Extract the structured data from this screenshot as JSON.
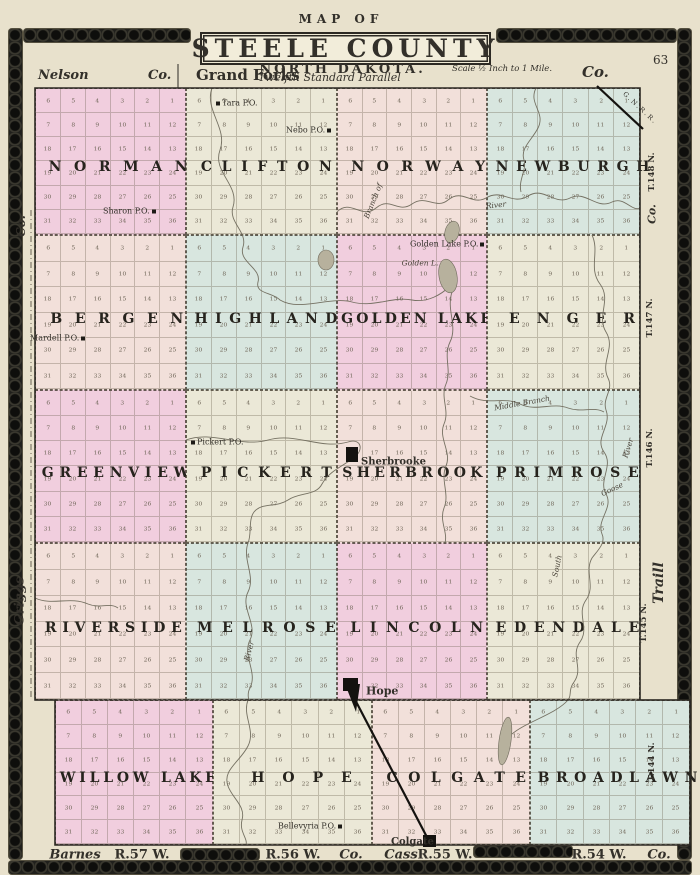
{
  "page_number": "63",
  "title": {
    "kicker": "MAP OF",
    "main": "STEELE COUNTY",
    "sub": "NORTH DAKOTA.",
    "scale": "Scale ½ Inch to 1 Mile."
  },
  "top_edge": {
    "nelson": "Nelson",
    "co_left": "Co.",
    "grand_forks": "Grand Forks",
    "parallel": "Twelfth Standard Parallel",
    "co_right": "Co."
  },
  "left_edge": [
    {
      "label": "Co.",
      "x": 21,
      "y": 226,
      "size": 12
    },
    {
      "label": "Griggs",
      "x": 20,
      "y": 601,
      "size": 13
    }
  ],
  "right_edge": [
    {
      "label": "T.148 N.",
      "x": 652,
      "y": 172,
      "size": 8.5
    },
    {
      "label": "Co.",
      "x": 652,
      "y": 214,
      "size": 11
    },
    {
      "label": "T.147 N.",
      "x": 650,
      "y": 318,
      "size": 8.5
    },
    {
      "label": "T.146 N.",
      "x": 650,
      "y": 448,
      "size": 8.5
    },
    {
      "label": "Traill",
      "x": 659,
      "y": 583,
      "size": 14
    },
    {
      "label": "T.145 N.",
      "x": 644,
      "y": 623,
      "size": 8.5
    },
    {
      "label": "T.144 N.",
      "x": 652,
      "y": 762,
      "size": 8.5
    }
  ],
  "bottom_edge": [
    {
      "label": "Barnes",
      "x": 75,
      "italic": true
    },
    {
      "label": "R.57 W.",
      "x": 142,
      "italic": false
    },
    {
      "label": "R.56 W.",
      "x": 293,
      "italic": false
    },
    {
      "label": "Co.",
      "x": 351,
      "italic": true
    },
    {
      "label": "Cass",
      "x": 401,
      "italic": true
    },
    {
      "label": "R.55 W.",
      "x": 445,
      "italic": false
    },
    {
      "label": "R.54 W.",
      "x": 599,
      "italic": false
    },
    {
      "label": "Co.",
      "x": 659,
      "italic": true
    }
  ],
  "standard_parallel_11": {
    "left": "11th Standard",
    "right": "Parallel"
  },
  "section_numbers": [
    [
      6,
      5,
      4,
      3,
      2,
      1
    ],
    [
      7,
      8,
      9,
      10,
      11,
      12
    ],
    [
      18,
      17,
      16,
      15,
      14,
      13
    ],
    [
      19,
      20,
      21,
      22,
      23,
      24
    ],
    [
      30,
      29,
      28,
      27,
      26,
      25
    ],
    [
      31,
      32,
      33,
      34,
      35,
      36
    ]
  ],
  "townships": [
    {
      "name": "NORMAN",
      "x": 35,
      "y": 88,
      "w": 151,
      "h": 147,
      "color": "pink"
    },
    {
      "name": "CLIFTON",
      "x": 186,
      "y": 88,
      "w": 151,
      "h": 147,
      "color": "cream"
    },
    {
      "name": "NORWAY",
      "x": 337,
      "y": 88,
      "w": 150,
      "h": 147,
      "color": "rose"
    },
    {
      "name": "NEWBURGH",
      "x": 487,
      "y": 88,
      "w": 153,
      "h": 147,
      "color": "blue"
    },
    {
      "name": "BERGEN",
      "x": 35,
      "y": 235,
      "w": 151,
      "h": 155,
      "color": "rose"
    },
    {
      "name": "HIGHLAND",
      "x": 186,
      "y": 235,
      "w": 151,
      "h": 155,
      "color": "blue"
    },
    {
      "name": "GOLDEN LAKE",
      "x": 337,
      "y": 235,
      "w": 150,
      "h": 155,
      "color": "pink"
    },
    {
      "name": "ENGER",
      "x": 487,
      "y": 235,
      "w": 153,
      "h": 155,
      "color": "cream"
    },
    {
      "name": "GREENVIEW",
      "x": 35,
      "y": 390,
      "w": 151,
      "h": 153,
      "color": "pink"
    },
    {
      "name": "PICKERT",
      "x": 186,
      "y": 390,
      "w": 151,
      "h": 153,
      "color": "cream"
    },
    {
      "name": "SHERBROOKE",
      "x": 337,
      "y": 390,
      "w": 150,
      "h": 153,
      "color": "rose"
    },
    {
      "name": "PRIMROSE",
      "x": 487,
      "y": 390,
      "w": 153,
      "h": 153,
      "color": "blue"
    },
    {
      "name": "RIVERSIDE",
      "x": 35,
      "y": 543,
      "w": 151,
      "h": 157,
      "color": "rose"
    },
    {
      "name": "MELROSE",
      "x": 186,
      "y": 543,
      "w": 151,
      "h": 157,
      "color": "blue"
    },
    {
      "name": "LINCOLN",
      "x": 337,
      "y": 543,
      "w": 150,
      "h": 157,
      "color": "pink"
    },
    {
      "name": "EDENDALE",
      "x": 487,
      "y": 543,
      "w": 153,
      "h": 157,
      "color": "cream"
    },
    {
      "name": "WILLOW LAKE",
      "x": 55,
      "y": 700,
      "w": 158,
      "h": 145,
      "color": "pink"
    },
    {
      "name": "HOPE",
      "x": 213,
      "y": 700,
      "w": 159,
      "h": 145,
      "color": "cream"
    },
    {
      "name": "COLGATE",
      "x": 372,
      "y": 700,
      "w": 158,
      "h": 145,
      "color": "rose"
    },
    {
      "name": "BROADLAWN",
      "x": 530,
      "y": 700,
      "w": 160,
      "h": 145,
      "color": "blue"
    }
  ],
  "places": [
    {
      "label": "Tara P.O.",
      "x": 216,
      "y": 103,
      "marker": "left"
    },
    {
      "label": "Nebo P.O.",
      "x": 288,
      "y": 130,
      "marker": "right"
    },
    {
      "label": "Sharon P.O.",
      "x": 105,
      "y": 211,
      "marker": "right"
    },
    {
      "label": "Golden Lake P.O.",
      "x": 412,
      "y": 244,
      "marker": "right"
    },
    {
      "label": "Mardell P.O.",
      "x": 32,
      "y": 338,
      "marker": "right"
    },
    {
      "label": "Pickert P.O.",
      "x": 191,
      "y": 442,
      "marker": "left"
    },
    {
      "label": "Bellevyria P.O.",
      "x": 280,
      "y": 826,
      "marker": "right"
    }
  ],
  "towns": [
    {
      "label": "Sherbrooke",
      "x": 361,
      "y": 462,
      "size": 10
    },
    {
      "label": "Hope",
      "x": 366,
      "y": 691,
      "size": 11
    },
    {
      "label": "Colgate",
      "x": 391,
      "y": 842,
      "size": 10
    }
  ],
  "town_blocks": [
    {
      "x": 346,
      "y": 447,
      "w": 12,
      "h": 15
    },
    {
      "x": 343,
      "y": 678,
      "w": 15,
      "h": 13
    },
    {
      "x": 423,
      "y": 835,
      "w": 13,
      "h": 12
    }
  ],
  "water_labels": [
    {
      "label": "Golden L.",
      "x": 420,
      "y": 263,
      "rot": 0
    },
    {
      "label": "Branch of",
      "x": 373,
      "y": 201,
      "rot": -68
    },
    {
      "label": "River",
      "x": 496,
      "y": 205,
      "rot": -6
    },
    {
      "label": "Middle Branch",
      "x": 522,
      "y": 403,
      "rot": -10
    },
    {
      "label": "River",
      "x": 628,
      "y": 448,
      "rot": -72
    },
    {
      "label": "Goose",
      "x": 612,
      "y": 489,
      "rot": -25
    },
    {
      "label": "South",
      "x": 557,
      "y": 566,
      "rot": -78
    },
    {
      "label": "River",
      "x": 249,
      "y": 651,
      "rot": -75
    }
  ],
  "railroads": [
    {
      "label": "G.N.R.R.",
      "x1": 597,
      "y1": 86,
      "x2": 643,
      "y2": 129
    },
    {
      "label": "",
      "x1": 351,
      "y1": 692,
      "x2": 429,
      "y2": 841
    }
  ],
  "water_paths": [
    "M212,88 C204,110 228,128 220,150 C212,172 240,185 233,207 C228,222 248,232 243,247 C238,262 262,268 258,282 C255,294 272,292 280,300 C300,312 330,296 352,302 C374,308 392,296 412,300 C428,303 442,294 450,286",
    "M337,212 C350,198 362,220 376,208 C390,196 398,214 412,204 C426,194 436,210 448,200 C462,188 472,206 486,198 C502,188 512,206 528,196 C544,186 554,206 570,198 C586,190 596,210 612,202 C624,196 632,212 640,208",
    "M536,88 C528,104 546,112 538,128 C532,140 520,148 524,160 C527,170 518,180 521,192",
    "M592,235 C600,252 588,268 600,284 C612,300 596,316 606,332 C616,348 600,362 608,378 C614,390 602,398 606,410 C612,426 594,438 604,452 C614,466 598,480 606,494 C614,508 596,520 602,534 C606,543 598,550 592,558 C584,572 596,586 586,600 C576,614 590,628 580,642 C570,656 584,668 574,682 C568,690 572,696 568,700 C556,714 526,722 512,734",
    "M470,396 C488,406 504,396 520,404 C536,412 552,402 568,408 C582,413 594,406 604,412",
    "M452,292 C446,310 458,326 450,342 C443,357 452,370 446,384 C440,398 450,410 444,424 C438,438 452,452 446,466 C440,480 450,494 444,508 C439,521 448,532 445,543",
    "M186,440 C212,430 240,448 268,440 C296,432 320,450 348,442 C360,438 364,448 356,456 C344,466 330,470 322,484 C316,496 300,492 288,500 C276,508 262,502 254,512 C248,520 252,534 248,543 C242,560 256,576 248,592 C240,608 258,624 250,640 C242,656 258,672 250,688 C246,695 250,700 248,700 C242,716 256,730 248,746 C240,762 222,770 228,786 C232,798 246,806 242,820 C239,832 248,838 246,845",
    "M35,598 C52,606 70,596 88,604 C100,609 110,602 118,608"
  ],
  "lakes": [
    {
      "cx": 452,
      "cy": 232,
      "rx": 7,
      "ry": 11,
      "rot": 15
    },
    {
      "cx": 448,
      "cy": 276,
      "rx": 9,
      "ry": 17,
      "rot": -10
    },
    {
      "cx": 326,
      "cy": 260,
      "rx": 8,
      "ry": 10,
      "rot": 0
    },
    {
      "cx": 505,
      "cy": 741,
      "rx": 6,
      "ry": 24,
      "rot": 8
    }
  ],
  "county_outline": "M35,88 L640,88 L640,700 L690,700 L690,845 L55,845 L55,700 L35,700 Z",
  "colors": {
    "pink": "#f1cede",
    "cream": "#ebe8d7",
    "rose": "#f2e0da",
    "blue": "#d8e6df",
    "paper": "#e8e1cc",
    "ink": "#2c2923",
    "water": "#6f6a5c",
    "lake": "#b7b19d"
  }
}
